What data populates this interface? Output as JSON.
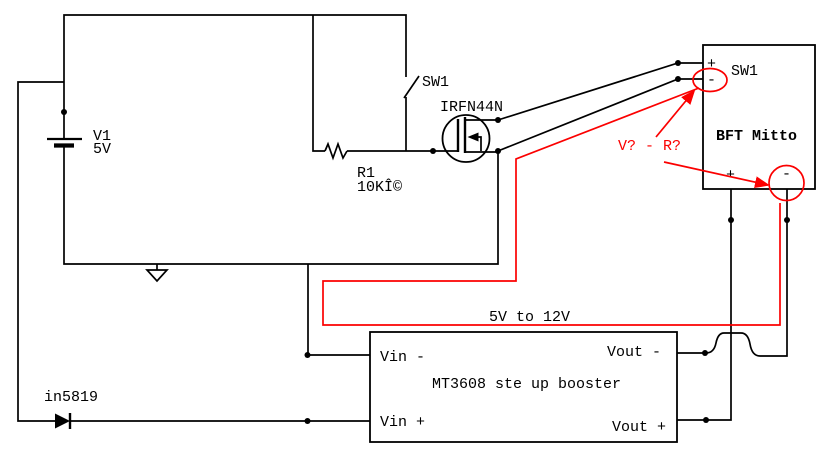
{
  "diagram_title": "5V to 12V booster driving BFT Mitto remote switch",
  "colors": {
    "wire": "#000000",
    "annotation": "#fb0000",
    "background": "#ffffff"
  },
  "components": {
    "battery": {
      "name": "V1",
      "value": "5V"
    },
    "switch": {
      "name": "SW1"
    },
    "mosfet": {
      "name": "IRFN44N"
    },
    "resistor": {
      "name": "R1",
      "value": "10KÎ©"
    },
    "diode": {
      "name": "in5819"
    },
    "receiver": {
      "name": "BFT Mitto",
      "switch_label": "SW1",
      "top_plus": "+",
      "top_minus": "-",
      "bottom_plus": "+",
      "bottom_minus": "-"
    },
    "booster": {
      "name": "MT3608 ste up booster",
      "vin_minus": "Vin -",
      "vin_plus": "Vin +",
      "vout_minus": "Vout -",
      "vout_plus": "Vout +"
    }
  },
  "annotations": {
    "question_label": "V? - R?",
    "conversion_label": "5V to 12V"
  }
}
